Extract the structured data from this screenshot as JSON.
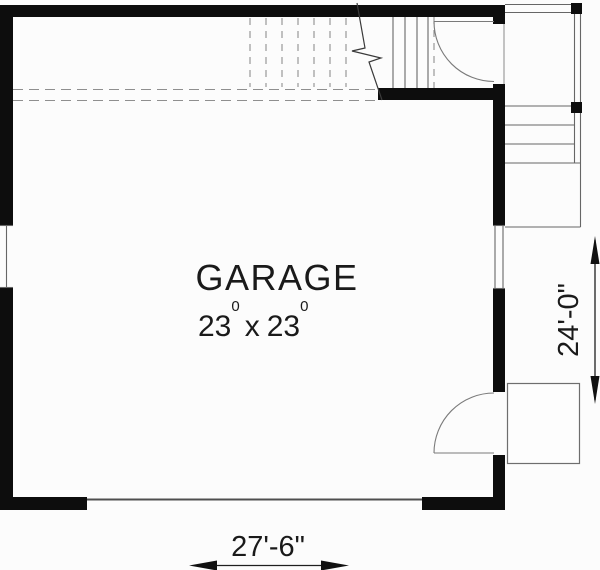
{
  "room": {
    "label": "GARAGE",
    "width_feet": "23",
    "width_sup": "0",
    "separator": "x",
    "depth_feet": "23",
    "depth_sup": "0"
  },
  "dimensions": {
    "bottom_width": "27'-6\"",
    "right_depth": "24'-0\""
  },
  "colors": {
    "wall": "#0d0d0d",
    "thin_line": "#666666",
    "dashed_line": "#8f8f8f",
    "text": "#1a1a1a",
    "background": "#fcfcfc"
  }
}
